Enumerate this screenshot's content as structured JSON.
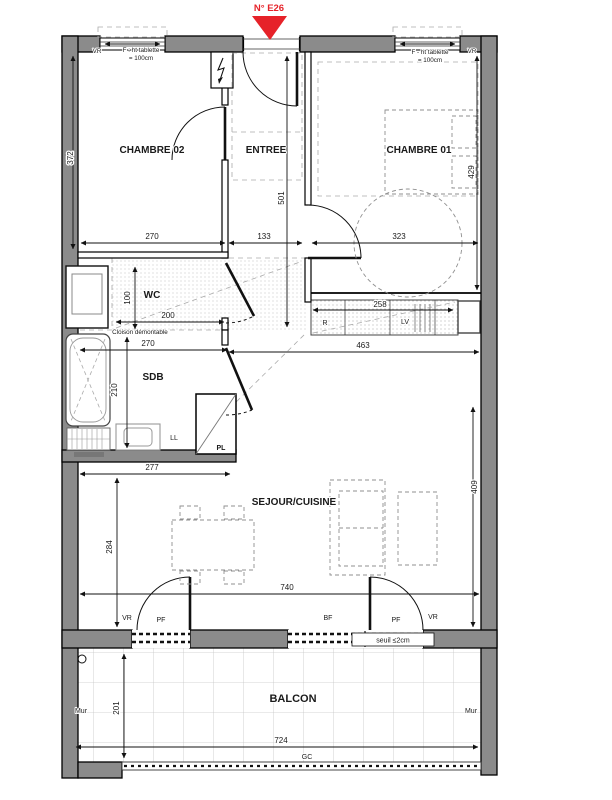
{
  "marker": {
    "label": "N° E26"
  },
  "rooms": {
    "chambre02": "CHAMBRE 02",
    "entree": "ENTREE",
    "chambre01": "CHAMBRE 01",
    "wc": "WC",
    "sdb": "SDB",
    "sejour_cuisine": "SEJOUR/CUISINE",
    "balcon": "BALCON"
  },
  "equipment": {
    "r": "R",
    "lv": "LV",
    "ll": "LL",
    "pl": "PL"
  },
  "window_notes": {
    "left_vr": "VR",
    "left_note1": "F : ht tablette",
    "left_note2": "= 100cm",
    "right_note1": "F - ht tablette",
    "right_note2": "= 100cm",
    "right_vr": "VR"
  },
  "bottom_openings": {
    "vr_left": "VR",
    "pf_left": "PF",
    "bf": "BF",
    "pf_right": "PF",
    "vr_right": "VR",
    "seuil": "seuil ≤2cm"
  },
  "balcony": {
    "mur_left": "Mur",
    "mur_right": "Mur",
    "gc": "GC"
  },
  "notes": {
    "cloison": "Cloison démontable"
  },
  "dims": {
    "chambre02_w": "270",
    "chambre02_h": "372",
    "entree_w": "133",
    "entree_h": "501",
    "chambre01_w": "323",
    "chambre01_h": "429",
    "wc_h": "100",
    "wc_w": "200",
    "kitchen_w": "258",
    "hall_kitchen_w": "463",
    "sdb_w": "270",
    "sdb_h": "210",
    "sejour_left_w": "277",
    "sejour_left_h": "284",
    "sejour_w": "740",
    "sejour_h": "409",
    "balcon_h": "201",
    "balcon_w": "724"
  },
  "colors": {
    "wall": "#8b8b8b",
    "accent_red": "#e62229",
    "hatch_dot": "#999999",
    "tile_line": "#c6c6c6"
  }
}
